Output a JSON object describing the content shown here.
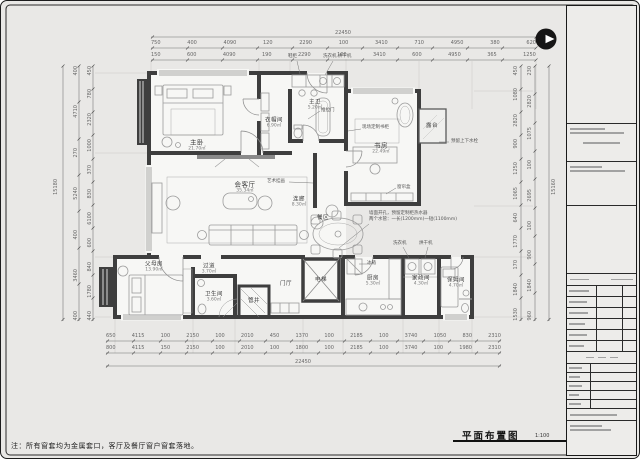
{
  "drawing": {
    "title": "平面布置图",
    "scale": "1:100",
    "note": "注：所有窗套均为金属套口，客厅及餐厅窗户窗套落地。"
  },
  "rooms": [
    {
      "name": "主卧",
      "area": "21.70㎡"
    },
    {
      "name": "衣帽间",
      "area": "6.90㎡"
    },
    {
      "name": "主卫",
      "area": "5.20㎡"
    },
    {
      "name": "书房",
      "area": "22.49㎡"
    },
    {
      "name": "露台",
      "area": ""
    },
    {
      "name": "会客厅",
      "area": "35.34㎡"
    },
    {
      "name": "连廊",
      "area": "8.30㎡"
    },
    {
      "name": "餐区",
      "area": ""
    },
    {
      "name": "电梯",
      "area": ""
    },
    {
      "name": "门厅",
      "area": ""
    },
    {
      "name": "厨房",
      "area": "5.30㎡"
    },
    {
      "name": "家政间",
      "area": "4.30㎡"
    },
    {
      "name": "保姆间",
      "area": "4.70㎡"
    },
    {
      "name": "父母房",
      "area": "13.90㎡"
    },
    {
      "name": "过道",
      "area": "3.70㎡"
    },
    {
      "name": "卫生间",
      "area": "3.60㎡"
    },
    {
      "name": "管井",
      "area": ""
    }
  ],
  "annotations": {
    "shoe_cabinet": "鞋柜",
    "washer_dryer": "洗衣机.烘干机",
    "sliding_door": "推拉门",
    "art_painting": "艺术挂画",
    "custom_bookcase": "现场定制书柜",
    "curtain_box": "窗帘盒",
    "water_outlet": "预留上下水栓",
    "kitchen_note": "墙面开孔，预留定制柜热水器\n两个水管：一长(1200mm)一短(1100mm)",
    "washing_machine": "洗衣机",
    "dryer": "烘干机",
    "fridge": "冰箱"
  },
  "dimensions": {
    "top_total": "22450",
    "top_row1": [
      "750",
      "400",
      "4090",
      "120",
      "2290",
      "100",
      "3410",
      "710",
      "4950",
      "380",
      "620"
    ],
    "top_row2": [
      "150",
      "600",
      "4090",
      "190",
      "2290",
      "100",
      "3410",
      "600",
      "4950",
      "365",
      "1250"
    ],
    "bottom_row1": [
      "650",
      "4115",
      "100",
      "2150",
      "100",
      "2010",
      "450",
      "1370",
      "100",
      "2185",
      "100",
      "3740",
      "1050",
      "830",
      "2310"
    ],
    "bottom_row2": [
      "800",
      "4115",
      "150",
      "2150",
      "100",
      "2010",
      "100",
      "1800",
      "100",
      "2185",
      "100",
      "3740",
      "100",
      "1980",
      "2310"
    ],
    "bottom_total": "22450",
    "left_col1": [
      "400",
      "4710",
      "270",
      "5240",
      "400",
      "3460",
      "400"
    ],
    "left_col2": [
      "450",
      "780",
      "2320",
      "1000",
      "370",
      "830",
      "6100",
      "600",
      "840",
      "1780",
      "440"
    ],
    "left_total": "15180",
    "right_col1": [
      "450",
      "1080",
      "2820",
      "900",
      "1250",
      "1065",
      "640",
      "1770",
      "170",
      "1840",
      "1530"
    ],
    "right_col2": [
      "230",
      "2820",
      "1075",
      "100",
      "2695",
      "100",
      "900",
      "1840",
      "960"
    ],
    "right_total": "15160"
  },
  "colors": {
    "wall": "#3e3e3e",
    "paper": "#f7f7f5",
    "furniture": "#9b9b9b",
    "dim": "#666666",
    "accent": "#111111"
  }
}
